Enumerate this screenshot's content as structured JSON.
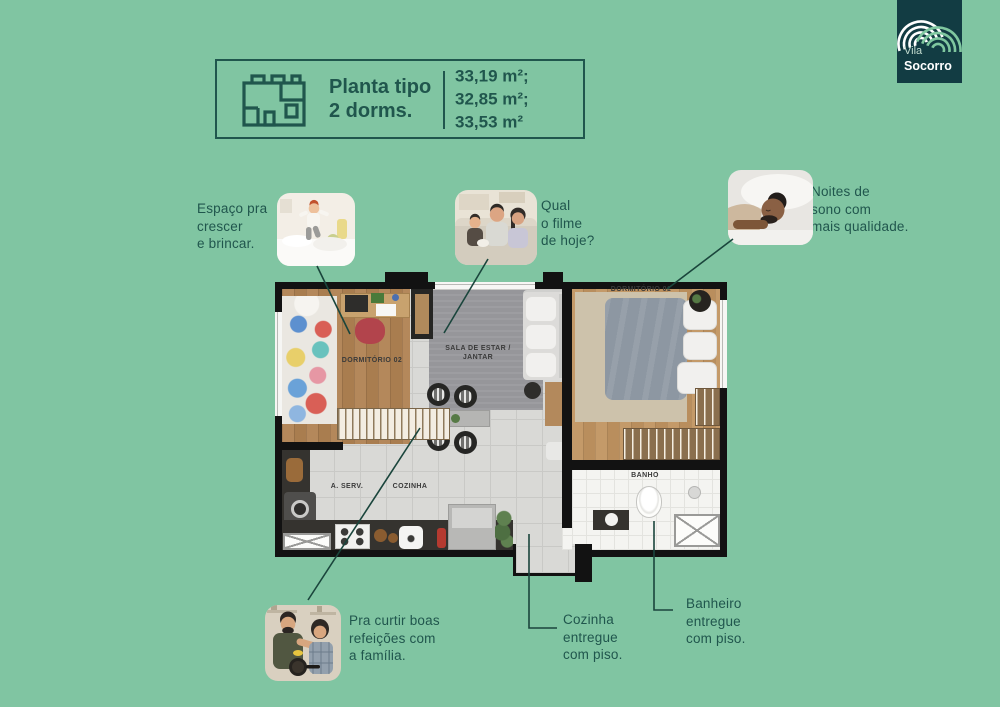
{
  "colors": {
    "background": "#80C5A2",
    "accent_text": "#20564D",
    "connector_line": "#1A453C",
    "logo_background": "#123C43",
    "logo_arc_green": "#7FC79F",
    "logo_arc_white": "#FFFFFF",
    "plan_wall": "#121212"
  },
  "header_card": {
    "icon": "floorplan-icon",
    "title": "Planta tipo\n2 dorms.",
    "areas": "33,19 m²;\n32,85 m²;\n33,53 m²"
  },
  "logo": {
    "icon": "vila-socorro-arcs-icon",
    "name_line1": "Vila",
    "name_line2": "Socorro"
  },
  "callouts": {
    "espaco": {
      "text": "Espaço pra\ncrescer\ne brincar.",
      "photo": "child-jumping-on-bed-photo"
    },
    "filme": {
      "text": "Qual\no filme\nde hoje?",
      "photo": "family-watching-movie-photo"
    },
    "noites": {
      "text": "Noites de\nsono com\nmais qualidade.",
      "photo": "man-sleeping-photo"
    },
    "refeicoes": {
      "text": "Pra curtir boas\nrefeições com\na família.",
      "photo": "couple-cooking-photo"
    },
    "cozinha": {
      "text": "Cozinha\nentregue\ncom piso."
    },
    "banheiro": {
      "text": "Banheiro\nentregue\ncom piso."
    }
  },
  "floor_plan": {
    "labels": {
      "dormitorio_02": "DORMITÓRIO 02",
      "sala": "SALA DE ESTAR /\nJANTAR",
      "dormitorio_01": "DORMITÓRIO 01",
      "banho": "BANHO",
      "area_servico": "A. SERV.",
      "cozinha": "COZINHA"
    }
  }
}
